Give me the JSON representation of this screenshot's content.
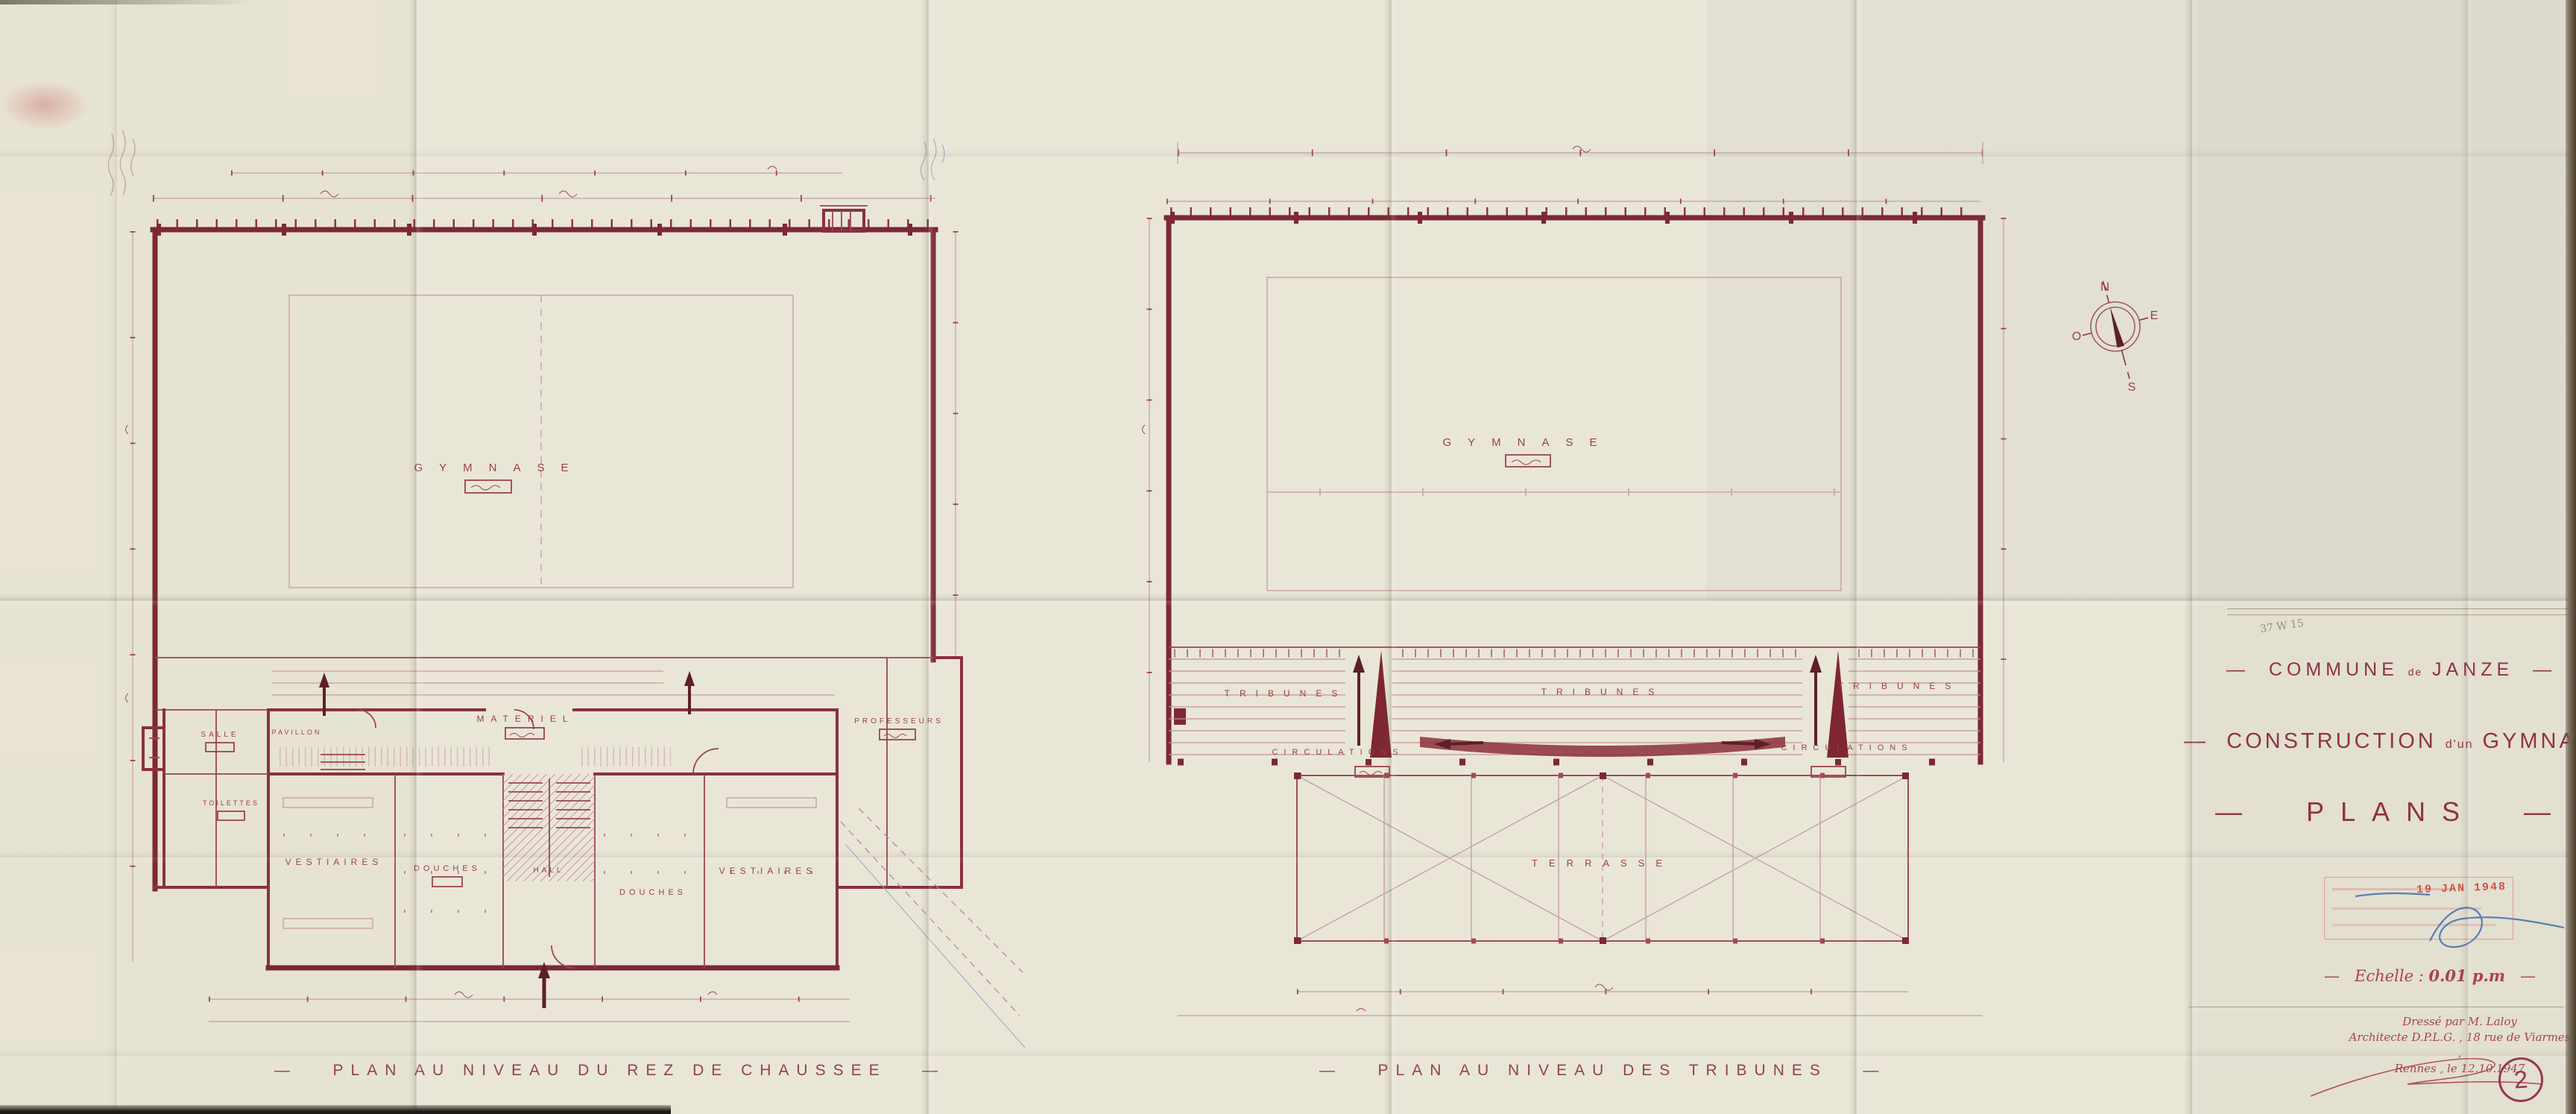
{
  "dash": "—",
  "compass": {
    "north": "N",
    "east": "E",
    "south": "S",
    "west": "O"
  },
  "plan_rdc": {
    "caption": "PLAN AU NIVEAU DU REZ DE CHAUSSEE",
    "labels": {
      "gymnase": "GYMNASE",
      "materiel": "MATERIEL",
      "professeurs": "PROFESSEURS",
      "vestiaires_l": "VESTIAIRES",
      "douches_l": "DOUCHES",
      "hall": "HALL",
      "douches_r": "DOUCHES",
      "vestiaires_r": "VESTIAIRES",
      "salle": "SALLE",
      "pavillon": "PAVILLON",
      "toilettes": "TOILETTES"
    }
  },
  "plan_tribunes": {
    "caption": "PLAN AU NIVEAU DES TRIBUNES",
    "labels": {
      "gymnase": "GYMNASE",
      "tribunes_l": "TRIBUNES",
      "tribunes_c": "TRIBUNES",
      "tribunes_r": "TRIBUNES",
      "circulations_l": "CIRCULATIONS",
      "circulations_r": "CIRCULATIONS",
      "terrasse": "TERRASSE"
    }
  },
  "title_block": {
    "archive_ref": "37 W 15",
    "commune_pre": "COMMUNE",
    "commune_mid": "de",
    "commune_post": "JANZE",
    "project_pre": "CONSTRUCTION",
    "project_mid": "d'un",
    "project_post": "GYMNASE",
    "sheet_title": "PLANS",
    "scale_label": "Echelle :",
    "scale_value": "0.01 p.m",
    "stamp_date": "19 JAN 1948",
    "credit_line1": "Dressé par M. Laloy",
    "credit_line2": "Architecte D.P.L.G. , 18 rue de Viarmes ,",
    "credit_line3": "Rennes , le 12.10.1947",
    "sheet_number": "2"
  }
}
